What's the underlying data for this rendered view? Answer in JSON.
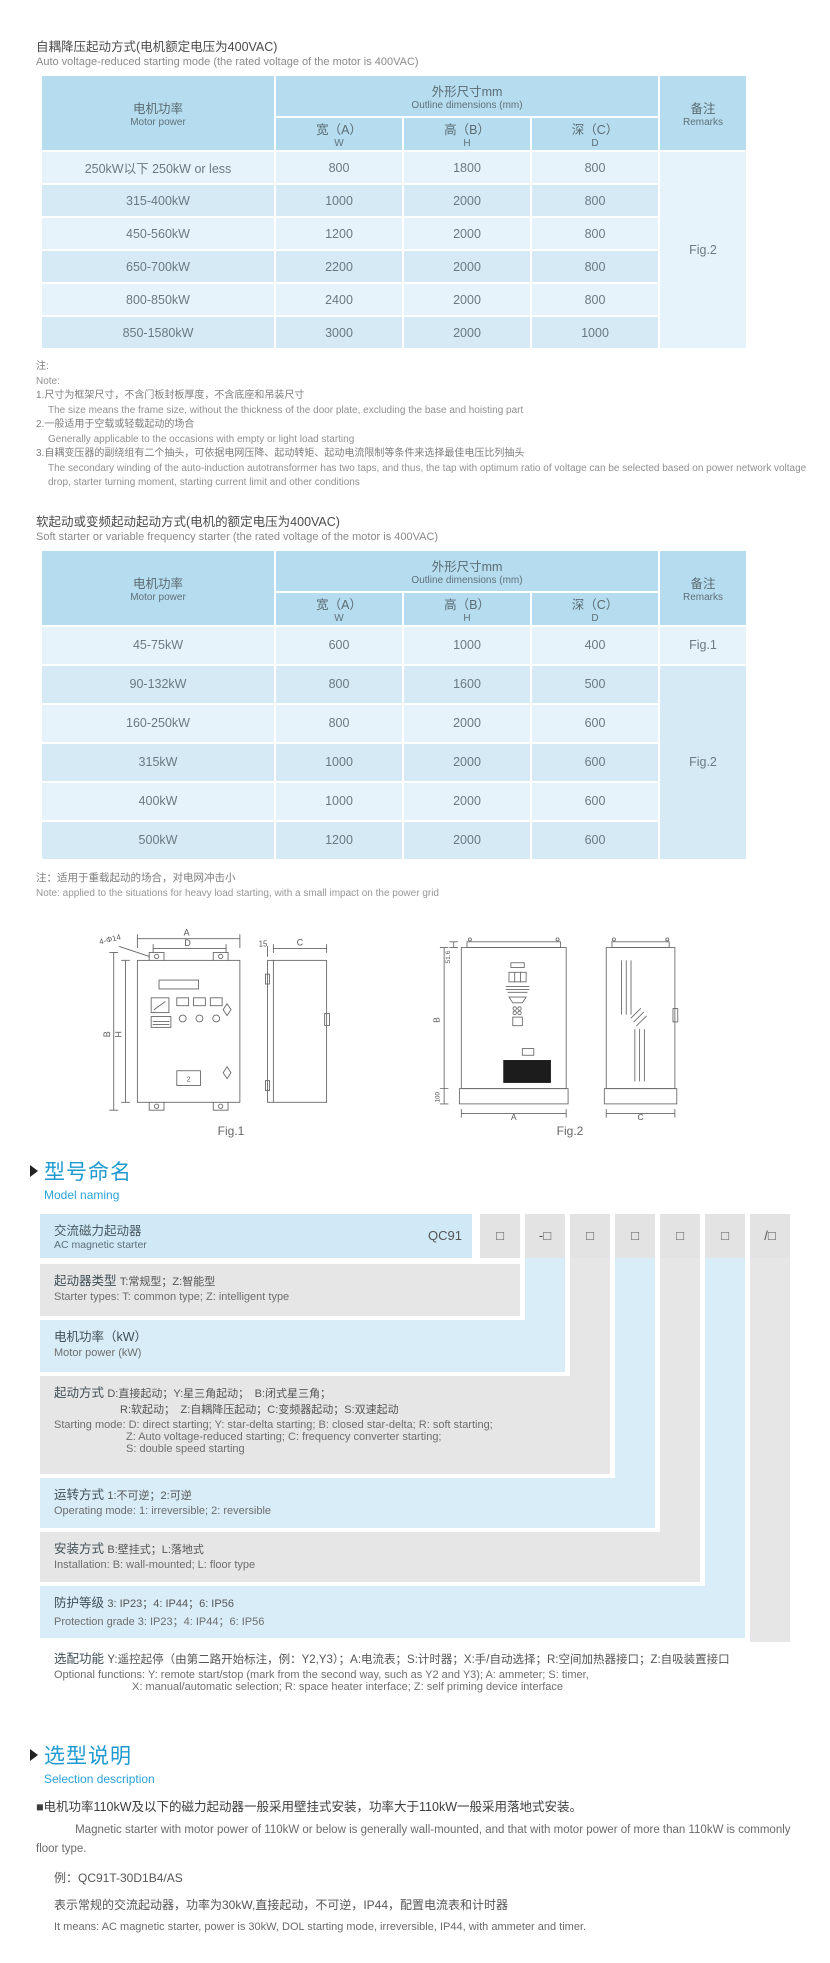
{
  "colors": {
    "accent_blue": "#1f9ad0",
    "table_header_bg": "#b6ddef",
    "row_light": "#e7f3fb",
    "row_dark": "#d6eaf6",
    "mn_gray": "#e6e6e6",
    "mn_blue": "#d9edf8"
  },
  "table1": {
    "title_cn": "自耦降压起动方式(电机额定电压为400VAC)",
    "title_en": "Auto voltage-reduced starting mode (the rated voltage of the motor is 400VAC)",
    "headers": {
      "power_cn": "电机功率",
      "power_en": "Motor power",
      "outline_cn": "外形尺寸mm",
      "outline_en": "Outline dimensions (mm)",
      "w_cn": "宽（A）",
      "w_en": "W",
      "h_cn": "高（B）",
      "h_en": "H",
      "d_cn": "深（C）",
      "d_en": "D",
      "remarks_cn": "备注",
      "remarks_en": "Remarks"
    },
    "rows": [
      {
        "power": "250kW以下 250kW or less",
        "w": "800",
        "h": "1800",
        "d": "800"
      },
      {
        "power": "315-400kW",
        "w": "1000",
        "h": "2000",
        "d": "800"
      },
      {
        "power": "450-560kW",
        "w": "1200",
        "h": "2000",
        "d": "800"
      },
      {
        "power": "650-700kW",
        "w": "2200",
        "h": "2000",
        "d": "800"
      },
      {
        "power": "800-850kW",
        "w": "2400",
        "h": "2000",
        "d": "800"
      },
      {
        "power": "850-1580kW",
        "w": "3000",
        "h": "2000",
        "d": "1000"
      }
    ],
    "remark": "Fig.2",
    "note": {
      "cn": "注:",
      "en": "Note:",
      "items": [
        {
          "cn": "1.尺寸为框架尺寸，不含门板封板厚度，不含底座和吊装尺寸",
          "en": "The size means the frame size, without the thickness of the door plate, excluding the base and hoisting part"
        },
        {
          "cn": "2.一般适用于空载或轻载起动的场合",
          "en": "Generally applicable to the occasions with empty or light load starting"
        },
        {
          "cn": "3.自耦变压器的副绕组有二个抽头，可依据电网压降、起动转矩、起动电流限制等条件来选择最佳电压比列抽头",
          "en": "The secondary winding of the auto-induction autotransformer has two taps, and thus, the tap with optimum ratio of voltage can be selected based on power network voltage drop, starter turning moment, starting current limit and other conditions"
        }
      ]
    }
  },
  "table2": {
    "title_cn": "软起动或变频起动起动方式(电机的额定电压为400VAC)",
    "title_en": "Soft starter or variable frequency starter (the rated voltage of the motor is 400VAC)",
    "rows": [
      {
        "power": "45-75kW",
        "w": "600",
        "h": "1000",
        "d": "400"
      },
      {
        "power": "90-132kW",
        "w": "800",
        "h": "1600",
        "d": "500"
      },
      {
        "power": "160-250kW",
        "w": "800",
        "h": "2000",
        "d": "600"
      },
      {
        "power": "315kW",
        "w": "1000",
        "h": "2000",
        "d": "600"
      },
      {
        "power": "400kW",
        "w": "1000",
        "h": "2000",
        "d": "600"
      },
      {
        "power": "500kW",
        "w": "1200",
        "h": "2000",
        "d": "600"
      }
    ],
    "remark_row1": "Fig.1",
    "remark_rest": "Fig.2",
    "note_cn": "注：适用于重载起动的场合，对电网冲击小",
    "note_en": "Note: applied to the situations for heavy load starting, with a small impact on the power grid"
  },
  "figures": {
    "fig1_label": "Fig.1",
    "fig2_label": "Fig.2",
    "fig1": {
      "dim_a": "A",
      "dim_d": "D",
      "dim_b": "B",
      "dim_h": "H",
      "dim_15": "15",
      "dim_c": "C",
      "callout": "4-Φ14",
      "panel_label": "2"
    },
    "fig2": {
      "dim_516": "51.6",
      "dim_b": "B",
      "dim_100": "100",
      "dim_a": "A",
      "dim_c": "C"
    }
  },
  "mn": {
    "title_cn": "型号命名",
    "title_en": "Model naming",
    "product_cn": "交流磁力起动器",
    "product_en": "AC magnetic starter",
    "code": "QC91",
    "b1": "□",
    "b2": "-□",
    "b3": "□",
    "b4": "□",
    "b5": "□",
    "b6": "□",
    "b7": "/□",
    "r1_key": "起动器类型",
    "r1_opts": "T:常规型；Z:智能型",
    "r1_en": "Starter types: T: common type; Z: intelligent type",
    "r2_key": "电机功率（kW）",
    "r2_en": "Motor power (kW)",
    "r3_key": "起动方式",
    "r3_opts": "D:直接起动；Y:星三角起动；　B:闭式星三角；",
    "r3_opts2": "R:软起动；　Z:自耦降压起动；C:变频器起动；S:双速起动",
    "r3_en": "Starting mode: D: direct starting; Y: star-delta starting; B: closed star-delta; R: soft starting;",
    "r3_en2": "Z: Auto voltage-reduced starting; C: frequency converter starting;",
    "r3_en3": "S: double speed starting",
    "r4_key": "运转方式",
    "r4_opts": "1:不可逆；2:可逆",
    "r4_en": "Operating mode: 1: irreversible; 2: reversible",
    "r5_key": "安装方式",
    "r5_opts": "B:壁挂式；L:落地式",
    "r5_en": "Installation: B: wall-mounted; L: floor type",
    "r6_key": "防护等级",
    "r6_opts": "3: IP23；4: IP44；6: IP56",
    "r6_en": "Protection grade  3: IP23；4: IP44；6: IP56",
    "r7_key": "选配功能",
    "r7_opts": "Y:遥控起停（由第二路开始标注，例：Y2,Y3）；A:电流表；S:计时器；X:手/自动选择；R:空间加热器接口；Z:自吸装置接口",
    "r7_en": "Optional functions: Y: remote start/stop (mark from the second way, such as Y2 and Y3); A: ammeter; S: timer,",
    "r7_en2": "X: manual/automatic selection; R: space heater interface; Z: self priming device interface"
  },
  "sel": {
    "title_cn": "选型说明",
    "title_en": "Selection description",
    "p1_cn": "■电机功率110kW及以下的磁力起动器一般采用壁挂式安装，功率大于110kW一般采用落地式安装。",
    "p1_en": "Magnetic starter with motor power of 110kW or below is generally wall-mounted, and that with motor power of more than 110kW is commonly floor type.",
    "example": "例：QC91T-30D1B4/AS",
    "p2_cn": "表示常规的交流起动器，功率为30kW,直接起动，不可逆，IP44，配置电流表和计时器",
    "p2_en": "It means: AC magnetic starter, power is 30kW, DOL starting mode, irreversible, IP44, with ammeter and timer."
  }
}
